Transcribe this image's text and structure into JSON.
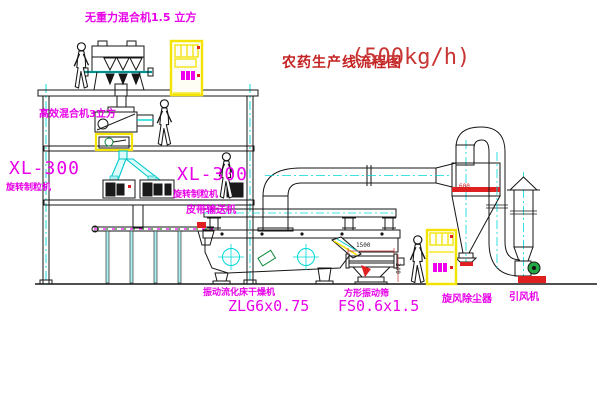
{
  "title": {
    "name_cn": "农药生产线流程图",
    "capacity": "(500kg/h)"
  },
  "labels": {
    "gravity_mixer": "无重力混合机1.5 立方",
    "he_mixer": "高效混合机3立方",
    "xl_left_model": "XL-300",
    "xl_left_name": "旋转制粒机",
    "xl_mid_model": "XL-300",
    "xl_mid_name": "旋转制粒机",
    "belt_conveyor": "皮带输送机",
    "dryer_name": "振动流化床干燥机",
    "dryer_model": "ZLG6x0.75",
    "sieve_name": "方形振动筛",
    "sieve_model": "FS0.6x1.5",
    "cyclone": "旋风除尘器",
    "fan": "引风机"
  },
  "dimensions": {
    "sieve_width": "1500",
    "sieve_height": "340",
    "cyclone_size": "600"
  },
  "colors": {
    "line": "#161616",
    "centerline_cyan": "#00d8d8",
    "label_magenta": "#e800e8",
    "title_red": "#c42222",
    "cabinet_yellow": "#f2e400",
    "marker_red": "#e02020",
    "fan_green": "#22aa44"
  }
}
